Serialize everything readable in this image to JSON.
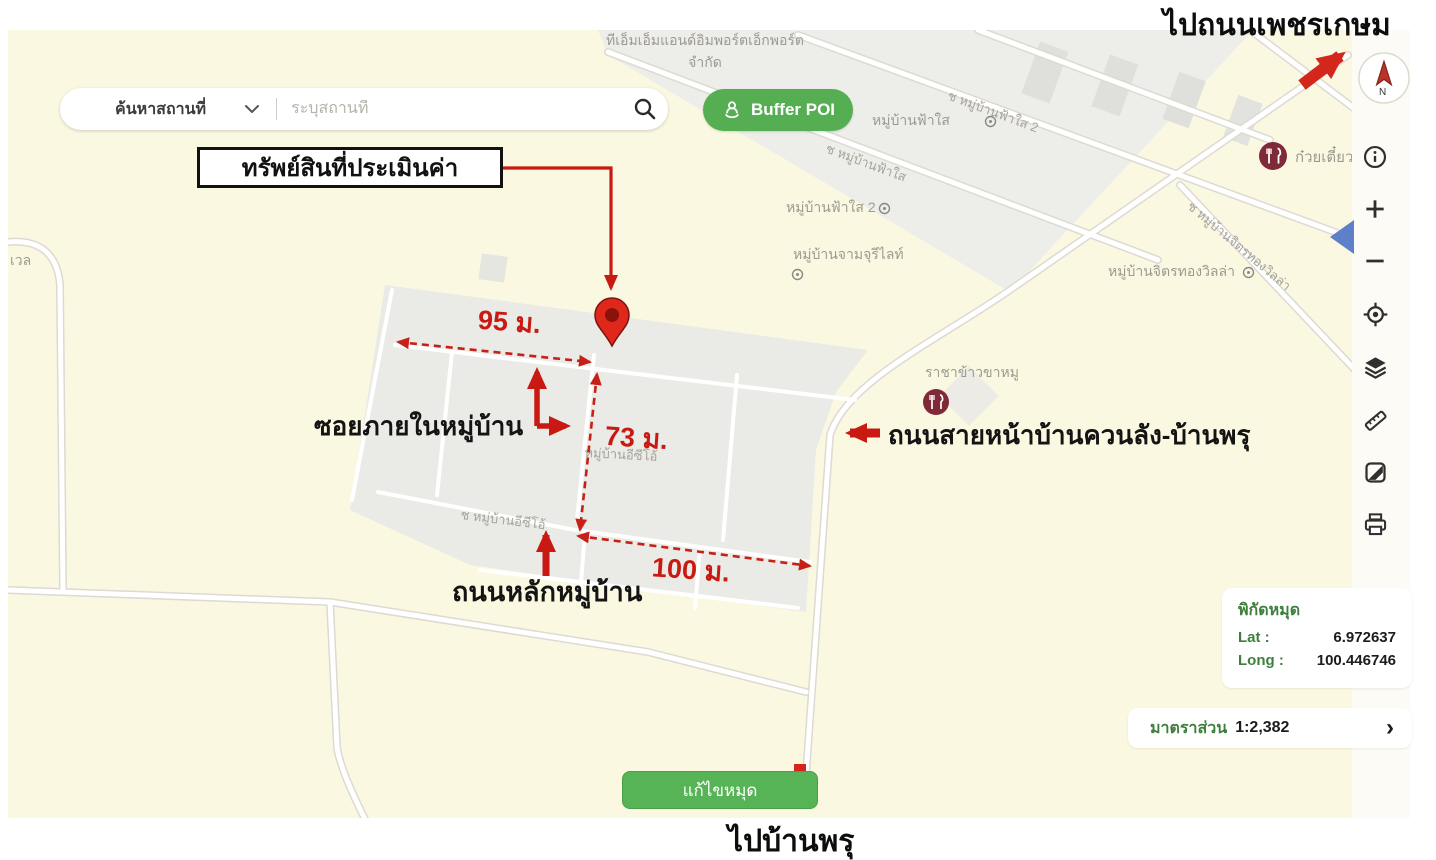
{
  "header": {
    "to_phetkasem": "ไปถนนเพชรเกษม",
    "to_banphru": "ไปบ้านพรุ"
  },
  "search": {
    "category": "ค้นหาสถานที่",
    "placeholder": "ระบุสถานที่"
  },
  "buttons": {
    "buffer_poi": "Buffer POI",
    "edit_pin": "แก้ไขหมุด"
  },
  "callout": {
    "appraised_property": "ทรัพย์สินที่ประเมินค่า"
  },
  "measurements": {
    "top": "95 ม.",
    "side": "73 ม.",
    "bottom": "100 ม."
  },
  "road_annotations": {
    "internal_soi": "ซอยภายในหมู่บ้าน",
    "village_main_road": "ถนนหลักหมู่บ้าน",
    "front_road": "ถนนสายหน้าบ้านควนลัง-บ้านพรุ"
  },
  "map_labels": {
    "company_line1": "ทีเอ็มเอ็มแอนด์อิมพอร์ตเอ็กพอร์ต",
    "company_line2": "จำกัด",
    "village_fasai": "หมู่บ้านฟ้าใส",
    "road_fasai": "ช หมู่บ้านฟ้าใส",
    "village_fasai2": "หมู่บ้านฟ้าใส 2",
    "road_fasai2": "ช หมู่บ้านฟ้าใส 2",
    "village_jamjuree": "หมู่บ้านจามจุรีไลท์",
    "village_jittrathong": "หมู่บ้านจิตรทองวิลล่า",
    "road_jittrathong": "ช หมู่บ้านจิตรทองวิลล่า",
    "village_ezio": "หมู่บ้านอีซีโอ้",
    "road_ezio": "ช หมู่บ้านอีซีโอ้",
    "partial_left": "เวล",
    "partial_right": "น"
  },
  "poi": {
    "restaurant_khamoo": "ราชาข้าวขาหมู",
    "restaurant_noodle": "ก๋วยเตี๋ยว"
  },
  "coords_panel": {
    "title": "พิกัดหมุด",
    "lat_label": "Lat :",
    "lat_value": "6.972637",
    "long_label": "Long :",
    "long_value": "100.446746"
  },
  "scale_panel": {
    "label": "มาตราส่วน",
    "value": "1:2,382",
    "chevron": "›"
  },
  "compass": {
    "n": "N"
  },
  "toolbar": {
    "icons": [
      "info",
      "zoom-in",
      "zoom-out",
      "locate",
      "layers",
      "measure",
      "basemap",
      "print"
    ]
  },
  "colors": {
    "annotation_red": "#C81A12",
    "button_green": "#56AE52",
    "panel_text_green": "#3E7F3E",
    "map_label_gray": "#9C9A90",
    "map_background": "#FBF8E1"
  }
}
